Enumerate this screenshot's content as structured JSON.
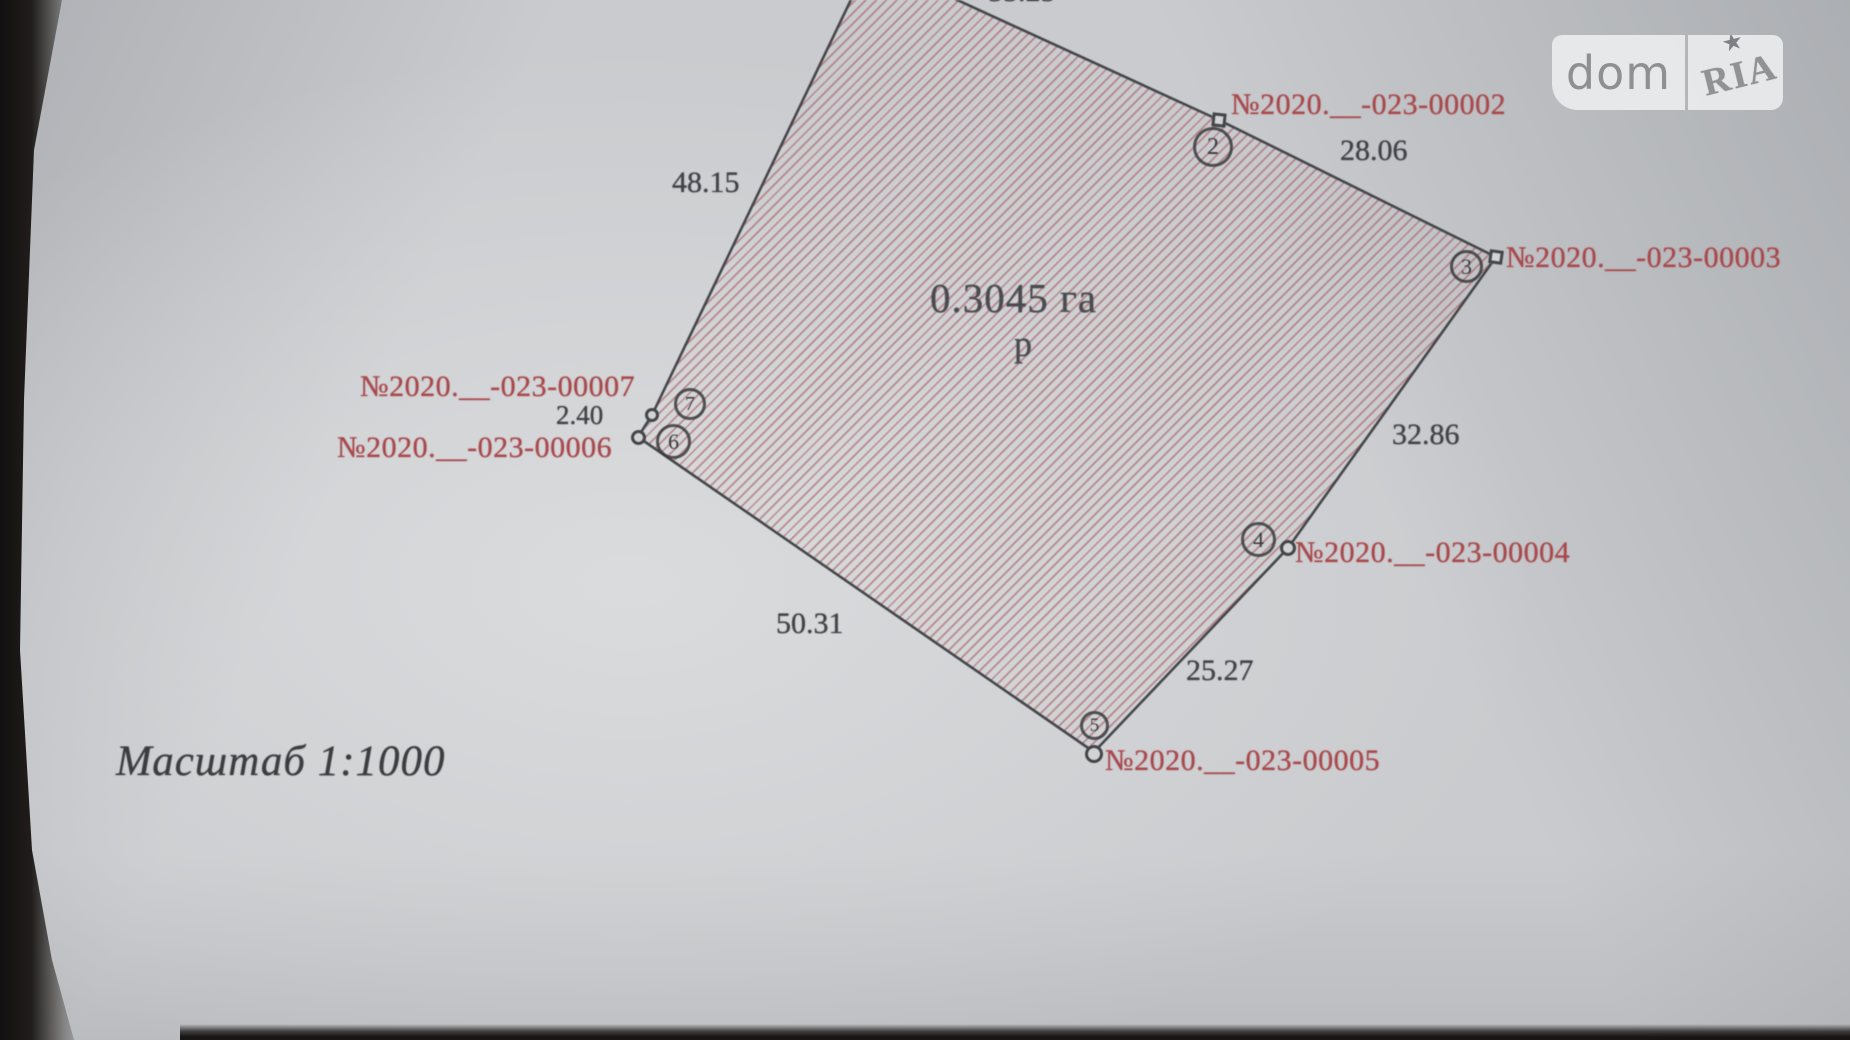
{
  "logo": {
    "dom": "dom",
    "ria": "RIA",
    "star": "★"
  },
  "plan": {
    "area": {
      "value": "0.3045 га",
      "sub": "р"
    },
    "scale_label": "Масштаб 1:1000",
    "dimensions": {
      "v1v2": "55.25",
      "v2v3": "28.06",
      "v3v4": "32.86",
      "v4v5": "25.27",
      "v5v6": "50.31",
      "v6v7": "2.40",
      "v7v1": "48.15"
    },
    "parcels": {
      "p2": "№2020.__-023-00002",
      "p3": "№2020.__-023-00003",
      "p4": "№2020.__-023-00004",
      "p5": "№2020.__-023-00005",
      "p6": "№2020.__-023-00006",
      "p7": "№2020.__-023-00007"
    },
    "vertices": {
      "v2": "2",
      "v3": "3",
      "v4": "4",
      "v5": "5",
      "v6": "6",
      "v7": "7"
    }
  },
  "colors": {
    "hatch_line": "#a75a5e",
    "plot_outline": "#45464a",
    "parcel_text": "#a8484c",
    "dimension_text": "#404247",
    "paper": "#c9cbce"
  }
}
